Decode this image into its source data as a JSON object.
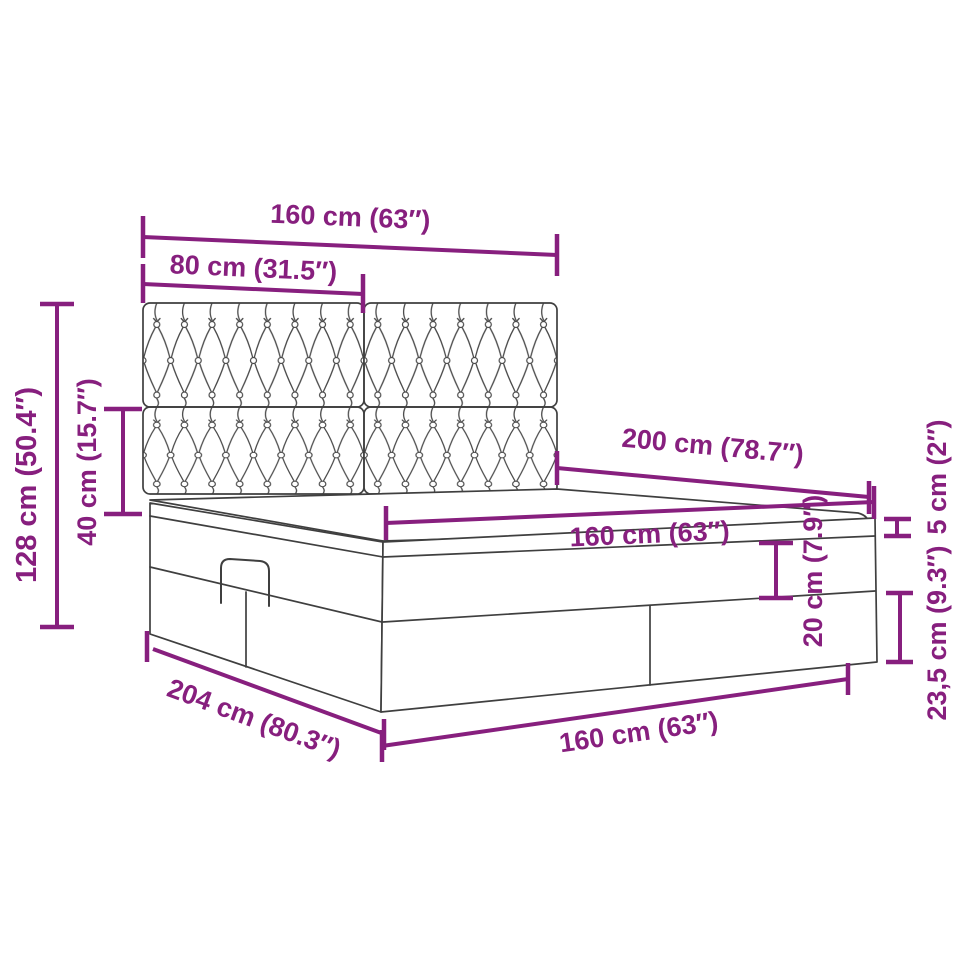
{
  "figure": {
    "subject": "ottoman storage bed with two-panel tufted headboard, line-art dimension drawing",
    "style": "technical product dimension diagram"
  },
  "colors": {
    "dimension_accent": "#871f7e",
    "line_art": "#3f3f3f",
    "background": "#ffffff"
  },
  "labels": {
    "headboard_width": "160 cm (63″)",
    "headboard_half_width": "80 cm (31.5″)",
    "overall_height": "128 cm (50.4″)",
    "headboard_lower_height": "40 cm (15.7″)",
    "mattress_length": "200 cm (78.7″)",
    "mattress_width": "160 cm (63″)",
    "topper_height": "5 cm (2″)",
    "mattress_height": "20 cm (7.9″)",
    "base_height": "23,5 cm (9.3″)",
    "bed_length": "204 cm (80.3″)",
    "bed_width": "160 cm (63″)"
  }
}
